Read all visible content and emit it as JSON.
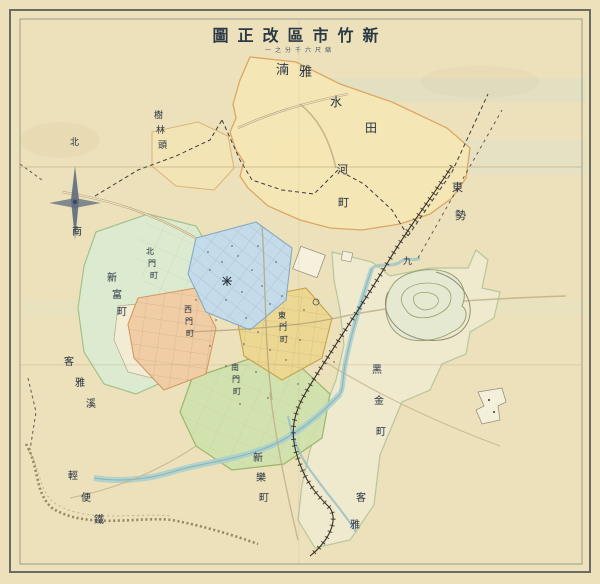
{
  "title": {
    "text": "新竹市區改正圖",
    "display": "圖正改區市竹新",
    "subtitle_text": "縮尺六千分之一",
    "subtitle_display": "一之分千六尺縮"
  },
  "compass": {
    "north_label": "北",
    "south_label": "南"
  },
  "colors": {
    "paper": "#ece1ba",
    "north_region_fill": "#f6e7b5",
    "north_region_line": "#dca45f",
    "green_region_fill": "#dcead0",
    "east_region_fill": "#f0ead0",
    "blue_district": "#c4dbe9",
    "salmon_district": "#f1cda6",
    "yellow_district": "#ecd892",
    "south_green_district": "#d2e2ae",
    "river": "#a9cfcd",
    "railway_ink": "#332f28",
    "label_ink": "#2e3947"
  },
  "labels": [
    {
      "name": "label-nanya",
      "text": "湳雅",
      "x": 276,
      "y": 64,
      "size": 13,
      "dx": 23,
      "dy": 2
    },
    {
      "name": "label-mizuta",
      "text": "水田",
      "x": 330,
      "y": 96,
      "size": 12,
      "dx": 35,
      "dy": 26
    },
    {
      "name": "label-kawa-cho",
      "text": "河町",
      "x": 337,
      "y": 164,
      "size": 11,
      "dx": 1,
      "dy": 33
    },
    {
      "name": "label-shulin-tou",
      "text": "樹林頭",
      "x": 154,
      "y": 112,
      "size": 9,
      "dx": 2,
      "dy": 15
    },
    {
      "name": "label-tung-shih",
      "text": "東勢",
      "x": 452,
      "y": 182,
      "size": 11,
      "dx": 3,
      "dy": 28
    },
    {
      "name": "label-chiu",
      "text": "九",
      "x": 403,
      "y": 258,
      "size": 9,
      "dx": 0,
      "dy": 0
    },
    {
      "name": "label-hsinfu-cho",
      "text": "新富町",
      "x": 107,
      "y": 274,
      "size": 10,
      "dx": 5,
      "dy": 17
    },
    {
      "name": "label-keya-creek",
      "text": "客雅溪",
      "x": 64,
      "y": 358,
      "size": 10,
      "dx": 11,
      "dy": 21
    },
    {
      "name": "label-heichin-cho",
      "text": "黑金町",
      "x": 372,
      "y": 366,
      "size": 10,
      "dx": 2,
      "dy": 31
    },
    {
      "name": "label-hsinle-cho",
      "text": "新樂町",
      "x": 253,
      "y": 454,
      "size": 10,
      "dx": 3,
      "dy": 20
    },
    {
      "name": "label-keya-south",
      "text": "客雅",
      "x": 356,
      "y": 494,
      "size": 10,
      "dx": -6,
      "dy": 27
    },
    {
      "name": "label-light-railway",
      "text": "輕便鐵",
      "x": 68,
      "y": 472,
      "size": 10,
      "dx": 13,
      "dy": 22
    },
    {
      "name": "label-compass-north",
      "text": "北",
      "x": 70,
      "y": 139,
      "size": 9,
      "dx": 0,
      "dy": 0
    },
    {
      "name": "label-compass-south",
      "text": "南",
      "x": 72,
      "y": 228,
      "size": 10,
      "dx": 0,
      "dy": 0
    },
    {
      "name": "label-beimen-cho",
      "text": "北門町",
      "x": 146,
      "y": 248,
      "size": 8,
      "dx": 2,
      "dy": 12
    },
    {
      "name": "label-ximen-cho",
      "text": "西門町",
      "x": 184,
      "y": 306,
      "size": 8,
      "dx": 1,
      "dy": 12
    },
    {
      "name": "label-nanmen-cho",
      "text": "南門町",
      "x": 231,
      "y": 364,
      "size": 8,
      "dx": 1,
      "dy": 12
    },
    {
      "name": "label-dongmen-cho",
      "text": "東門町",
      "x": 278,
      "y": 312,
      "size": 8,
      "dx": 1,
      "dy": 12
    }
  ]
}
